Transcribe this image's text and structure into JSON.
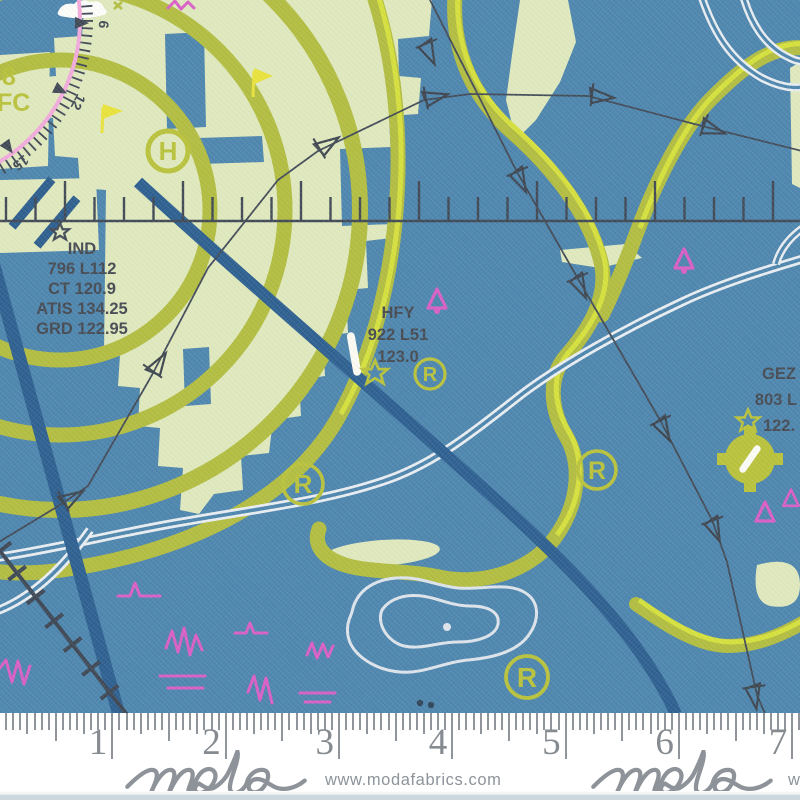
{
  "map": {
    "edge_labels": {
      "l1": "8",
      "l2": "FC"
    },
    "compass": {
      "numbers": [
        "6",
        "12",
        "15"
      ]
    },
    "symbols": {
      "heliport": "H",
      "restricted": "R"
    },
    "airports": {
      "ind": {
        "lines": [
          "IND",
          "796 L112",
          "CT 120.9",
          "ATIS 134.25",
          "GRD 122.95"
        ]
      },
      "hfy": {
        "lines": [
          "HFY",
          "922 L51",
          "123.0"
        ]
      },
      "gez": {
        "lines": [
          "GEZ",
          "803 L",
          "122."
        ]
      }
    },
    "colors": {
      "background_blue": "#4e86ae",
      "land_pale_green": "#dfe8bd",
      "band_olive": "#b2bd41",
      "band_highlight": "#d7e13d",
      "airway_navy": "#2e6090",
      "line_dark_slate": "#434c58",
      "magenta": "#d95fc6",
      "compass_pink": "#f1abdb",
      "road_white": "#e8edf1"
    }
  },
  "ruler": {
    "numbers": [
      "1",
      "2",
      "3",
      "4",
      "5",
      "6",
      "7"
    ]
  },
  "branding": {
    "logo_text": "moda",
    "url": "www.modafabrics.com"
  }
}
